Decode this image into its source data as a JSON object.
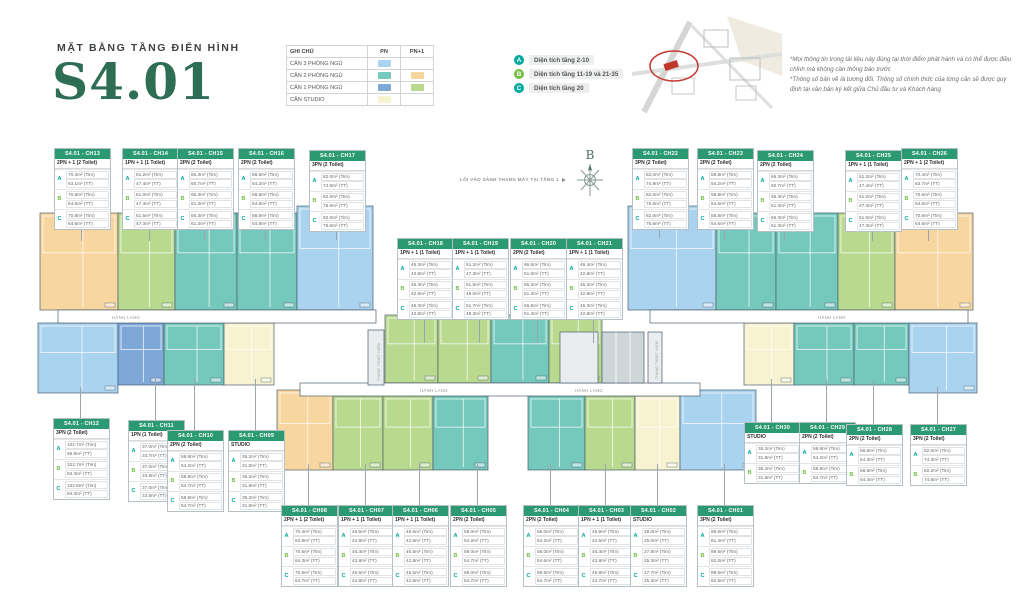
{
  "header": {
    "subtitle": "MẶT BẰNG TẦNG ĐIỂN HÌNH",
    "title": "S4.01"
  },
  "colors": {
    "pn3": "#a9d3ee",
    "pn2": "#74c8bc",
    "pn2p1": "#f8d6a0",
    "pn1": "#7ea8d8",
    "pn1p1": "#b9d98e",
    "studio": "#f7f2d0",
    "accent_teal": "#00a99d",
    "accent_green": "#72bf44",
    "header_green": "#2b9a72",
    "title_green": "#2e6e55"
  },
  "legend": {
    "title": "GHI CHÚ",
    "columns": [
      "PN",
      "PN+1"
    ],
    "rows": [
      {
        "label": "CĂN 3 PHÒNG NGỦ",
        "pn": "pn3",
        "pn1": null
      },
      {
        "label": "CĂN 2 PHÒNG NGỦ",
        "pn": "pn2",
        "pn1": "pn2p1"
      },
      {
        "label": "CĂN 1 PHÒNG NGỦ",
        "pn": "pn1",
        "pn1": "pn1p1"
      },
      {
        "label": "CĂN STUDIO",
        "pn": "studio",
        "pn1": null
      }
    ]
  },
  "floors_legend": [
    {
      "key": "A",
      "color": "teal",
      "label": "Diện tích tầng 2-10"
    },
    {
      "key": "B",
      "color": "green",
      "label": "Diện tích tầng 11-19 và 21-35"
    },
    {
      "key": "C",
      "color": "teal",
      "label": "Diện tích tầng 20"
    }
  ],
  "disclaimer": {
    "lines": [
      "*Mọi thông tin trong tài liệu này đúng tại thời điểm phát hành và có thể được điều chỉnh mà không cần thông báo trước",
      "*Thông số bản vẽ là tương đối. Thông số chính thức của từng căn sẽ được quy định tại văn bản ký kết giữa Chủ đầu tư và Khách hàng"
    ]
  },
  "compass_label": "B",
  "plan": {
    "entry_note": "LỐI VÀO SẢNH THANG MÁY TẠI TẦNG 1",
    "corridor_label": "HÀNH LANG",
    "stair_label": "THANG THOÁT HIỂM",
    "corridors": [
      {
        "x": 58,
        "y": 310,
        "w": 318,
        "h": 13,
        "label_x": [
          112
        ]
      },
      {
        "x": 650,
        "y": 310,
        "w": 318,
        "h": 13,
        "label_x": [
          818
        ]
      },
      {
        "x": 300,
        "y": 383,
        "w": 400,
        "h": 13,
        "label_x": [
          420,
          575
        ]
      }
    ],
    "cores": [
      {
        "x": 368,
        "y": 330,
        "w": 16,
        "h": 55,
        "kind": "stair"
      },
      {
        "x": 560,
        "y": 332,
        "w": 38,
        "h": 51,
        "kind": "lobby"
      },
      {
        "x": 602,
        "y": 332,
        "w": 42,
        "h": 51,
        "kind": "elevator"
      },
      {
        "x": 648,
        "y": 332,
        "w": 14,
        "h": 51,
        "kind": "stair"
      }
    ]
  },
  "units": [
    {
      "id": "S4.01 - CH13",
      "type": "2PN + 1 (2 Toilet)",
      "t": "pn2p1",
      "card": {
        "x": 54,
        "y": 148
      },
      "plan": {
        "x": 40,
        "y": 213,
        "w": 78,
        "h": 97
      },
      "rows": [
        [
          "A",
          "70.4m² (Tim)",
          "63.1m² (TT)"
        ],
        [
          "B",
          "70.8m² (Tim)",
          "64.6m² (TT)"
        ],
        [
          "C",
          "70.8m² (Tim)",
          "64.6m² (TT)"
        ]
      ]
    },
    {
      "id": "S4.01 - CH14",
      "type": "1PN + 1 (1 Toilet)",
      "t": "pn1p1",
      "card": {
        "x": 122,
        "y": 148
      },
      "plan": {
        "x": 118,
        "y": 213,
        "w": 57,
        "h": 97
      },
      "rows": [
        [
          "A",
          "51.2m² (Tim)",
          "47.4m² (TT)"
        ],
        [
          "B",
          "51.0m² (Tim)",
          "47.3m² (TT)"
        ],
        [
          "C",
          "51.5m² (Tim)",
          "47.3m² (TT)"
        ]
      ]
    },
    {
      "id": "S4.01 - CH15",
      "type": "2PN (2 Toilet)",
      "t": "pn2",
      "card": {
        "x": 177,
        "y": 148
      },
      "plan": {
        "x": 175,
        "y": 213,
        "w": 62,
        "h": 97
      },
      "rows": [
        [
          "A",
          "66.3m² (Tim)",
          "60.7m² (TT)"
        ],
        [
          "B",
          "66.3m² (Tim)",
          "61.3m² (TT)"
        ],
        [
          "C",
          "66.3m² (Tim)",
          "61.3m² (TT)"
        ]
      ]
    },
    {
      "id": "S4.01 - CH16",
      "type": "2PN (2 Toilet)",
      "t": "pn2",
      "card": {
        "x": 238,
        "y": 148
      },
      "plan": {
        "x": 237,
        "y": 213,
        "w": 60,
        "h": 97
      },
      "rows": [
        [
          "A",
          "58.8m² (Tim)",
          "54.2m² (TT)"
        ],
        [
          "B",
          "58.8m² (Tim)",
          "54.8m² (TT)"
        ],
        [
          "C",
          "58.8m² (Tim)",
          "54.8m² (TT)"
        ]
      ]
    },
    {
      "id": "S4.01 - CH17",
      "type": "3PN (2 Toilet)",
      "t": "pn3",
      "card": {
        "x": 309,
        "y": 150
      },
      "plan": {
        "x": 297,
        "y": 206,
        "w": 76,
        "h": 104
      },
      "rows": [
        [
          "A",
          "82.0m² (Tim)",
          "74.9m² (TT)"
        ],
        [
          "B",
          "82.0m² (Tim)",
          "75.6m² (TT)"
        ],
        [
          "C",
          "82.0m² (Tim)",
          "75.6m² (TT)"
        ]
      ]
    },
    {
      "id": "S4.01 - CH18",
      "type": "1PN + 1 (1 Toilet)",
      "t": "pn1p1",
      "card": {
        "x": 397,
        "y": 238
      },
      "plan": {
        "x": 385,
        "y": 315,
        "w": 53,
        "h": 68
      },
      "rows": [
        [
          "A",
          "46.3m² (Tim)",
          "42.8m² (TT)"
        ],
        [
          "B",
          "46.3m² (Tim)",
          "42.8m² (TT)"
        ],
        [
          "C",
          "46.3m² (Tim)",
          "42.8m² (TT)"
        ]
      ]
    },
    {
      "id": "S4.01 - CH19",
      "type": "1PN + 1 (1 Toilet)",
      "t": "pn1p1",
      "card": {
        "x": 452,
        "y": 238
      },
      "plan": {
        "x": 438,
        "y": 315,
        "w": 53,
        "h": 68
      },
      "rows": [
        [
          "A",
          "51.2m² (Tim)",
          "47.3m² (TT)"
        ],
        [
          "B",
          "51.5m² (Tim)",
          "48.0m² (TT)"
        ],
        [
          "C",
          "51.7m² (Tim)",
          "48.3m² (TT)"
        ]
      ]
    },
    {
      "id": "S4.01 - CH20",
      "type": "2PN (2 Toilet)",
      "t": "pn2",
      "card": {
        "x": 510,
        "y": 238
      },
      "plan": {
        "x": 491,
        "y": 315,
        "w": 58,
        "h": 68
      },
      "rows": [
        [
          "A",
          "66.6m² (Tim)",
          "61.0m² (TT)"
        ],
        [
          "B",
          "66.3m² (Tim)",
          "61.3m² (TT)"
        ],
        [
          "C",
          "66.6m² (Tim)",
          "61.4m² (TT)"
        ]
      ]
    },
    {
      "id": "S4.01 - CH21",
      "type": "1PN + 1 (1 Toilet)",
      "t": "pn1p1",
      "card": {
        "x": 566,
        "y": 238
      },
      "plan": {
        "x": 549,
        "y": 315,
        "w": 53,
        "h": 68
      },
      "rows": [
        [
          "A",
          "46.4m² (Tim)",
          "42.8m² (TT)"
        ],
        [
          "B",
          "46.3m² (Tim)",
          "42.8m² (TT)"
        ],
        [
          "C",
          "46.3m² (Tim)",
          "42.8m² (TT)"
        ]
      ]
    },
    {
      "id": "S4.01 - CH22",
      "type": "3PN (2 Toilet)",
      "t": "pn3",
      "card": {
        "x": 632,
        "y": 148
      },
      "plan": {
        "x": 628,
        "y": 206,
        "w": 88,
        "h": 104
      },
      "rows": [
        [
          "A",
          "82.0m² (Tim)",
          "74.9m² (TT)"
        ],
        [
          "B",
          "82.0m² (Tim)",
          "75.6m² (TT)"
        ],
        [
          "C",
          "82.0m² (Tim)",
          "75.6m² (TT)"
        ]
      ]
    },
    {
      "id": "S4.01 - CH23",
      "type": "2PN (2 Toilet)",
      "t": "pn2",
      "card": {
        "x": 697,
        "y": 148
      },
      "plan": {
        "x": 716,
        "y": 213,
        "w": 60,
        "h": 97
      },
      "rows": [
        [
          "A",
          "58.8m² (Tim)",
          "54.2m² (TT)"
        ],
        [
          "B",
          "58.8m² (Tim)",
          "54.6m² (TT)"
        ],
        [
          "C",
          "58.8m² (Tim)",
          "54.6m² (TT)"
        ]
      ]
    },
    {
      "id": "S4.01 - CH24",
      "type": "2PN (2 Toilet)",
      "t": "pn2",
      "card": {
        "x": 757,
        "y": 150
      },
      "plan": {
        "x": 776,
        "y": 213,
        "w": 62,
        "h": 97
      },
      "rows": [
        [
          "A",
          "66.3m² (Tim)",
          "60.7m² (TT)"
        ],
        [
          "B",
          "66.3m² (Tim)",
          "61.3m² (TT)"
        ],
        [
          "C",
          "66.3m² (Tim)",
          "61.3m² (TT)"
        ]
      ]
    },
    {
      "id": "S4.01 - CH25",
      "type": "1PN + 1 (1 Toilet)",
      "t": "pn1p1",
      "card": {
        "x": 845,
        "y": 150
      },
      "plan": {
        "x": 838,
        "y": 213,
        "w": 57,
        "h": 97
      },
      "rows": [
        [
          "A",
          "51.2m² (Tim)",
          "47.4m² (TT)"
        ],
        [
          "B",
          "51.2m² (Tim)",
          "47.3m² (TT)"
        ],
        [
          "C",
          "51.5m² (Tim)",
          "47.3m² (TT)"
        ]
      ]
    },
    {
      "id": "S4.01 - CH26",
      "type": "2PN + 1 (2 Toilet)",
      "t": "pn2p1",
      "card": {
        "x": 901,
        "y": 148
      },
      "plan": {
        "x": 895,
        "y": 213,
        "w": 78,
        "h": 97
      },
      "rows": [
        [
          "A",
          "70.4m² (Tim)",
          "63.7m² (TT)"
        ],
        [
          "B",
          "70.6m² (Tim)",
          "64.6m² (TT)"
        ],
        [
          "C",
          "70.6m² (Tim)",
          "64.6m² (TT)"
        ]
      ]
    },
    {
      "id": "S4.01 - CH12",
      "type": "3PN (2 Toilet)",
      "t": "pn3",
      "card": {
        "x": 53,
        "y": 418
      },
      "plan": {
        "x": 38,
        "y": 323,
        "w": 80,
        "h": 70
      },
      "rows": [
        [
          "A",
          "102.7m² (Tim)",
          "95.8m² (TT)"
        ],
        [
          "B",
          "102.7m² (Tim)",
          "94.3m² (TT)"
        ],
        [
          "C",
          "102.8m² (Tim)",
          "94.3m² (TT)"
        ]
      ]
    },
    {
      "id": "S4.01 - CH11",
      "type": "1PN (1 Toilet)",
      "t": "pn1",
      "card": {
        "x": 128,
        "y": 420
      },
      "plan": {
        "x": 118,
        "y": 323,
        "w": 46,
        "h": 62
      },
      "rows": [
        [
          "A",
          "37.0m² (Tim)",
          "33.7m² (TT)"
        ],
        [
          "B",
          "37.0m² (Tim)",
          "33.8m² (TT)"
        ],
        [
          "C",
          "37.0m² (Tim)",
          "33.8m² (TT)"
        ]
      ]
    },
    {
      "id": "S4.01 - CH10",
      "type": "2PN (2 Toilet)",
      "t": "pn2",
      "card": {
        "x": 167,
        "y": 430
      },
      "plan": {
        "x": 164,
        "y": 323,
        "w": 60,
        "h": 62
      },
      "rows": [
        [
          "A",
          "58.8m² (Tim)",
          "54.2m² (TT)"
        ],
        [
          "B",
          "58.8m² (Tim)",
          "54.7m² (TT)"
        ],
        [
          "C",
          "58.8m² (Tim)",
          "54.7m² (TT)"
        ]
      ]
    },
    {
      "id": "S4.01 - CH09",
      "type": "STUDIO",
      "t": "studio",
      "card": {
        "x": 228,
        "y": 430
      },
      "plan": {
        "x": 224,
        "y": 323,
        "w": 50,
        "h": 62
      },
      "rows": [
        [
          "A",
          "35.2m² (Tim)",
          "31.8m² (TT)"
        ],
        [
          "B",
          "35.2m² (Tim)",
          "31.8m² (TT)"
        ],
        [
          "C",
          "35.2m² (Tim)",
          "31.8m² (TT)"
        ]
      ]
    },
    {
      "id": "S4.01 - CH30",
      "type": "STUDIO",
      "t": "studio",
      "card": {
        "x": 744,
        "y": 422
      },
      "plan": {
        "x": 744,
        "y": 323,
        "w": 50,
        "h": 62
      },
      "rows": [
        [
          "A",
          "35.2m² (Tim)",
          "31.8m² (TT)"
        ],
        [
          "B",
          "35.2m² (Tim)",
          "31.8m² (TT)"
        ]
      ]
    },
    {
      "id": "S4.01 - CH29",
      "type": "2PN (2 Toilet)",
      "t": "pn2",
      "card": {
        "x": 799,
        "y": 422
      },
      "plan": {
        "x": 794,
        "y": 323,
        "w": 60,
        "h": 62
      },
      "rows": [
        [
          "A",
          "58.8m² (Tim)",
          "54.2m² (TT)"
        ],
        [
          "B",
          "58.8m² (Tim)",
          "54.7m² (TT)"
        ]
      ]
    },
    {
      "id": "S4.01 - CH28",
      "type": "2PN (2 Toilet)",
      "t": "pn2",
      "card": {
        "x": 846,
        "y": 424
      },
      "plan": {
        "x": 854,
        "y": 323,
        "w": 55,
        "h": 62
      },
      "rows": [
        [
          "A",
          "58.8m² (Tim)",
          "54.3m² (TT)"
        ],
        [
          "B",
          "58.8m² (Tim)",
          "54.4m² (TT)"
        ]
      ]
    },
    {
      "id": "S4.01 - CH27",
      "type": "3PN (2 Toilet)",
      "t": "pn3",
      "card": {
        "x": 910,
        "y": 424
      },
      "plan": {
        "x": 909,
        "y": 323,
        "w": 68,
        "h": 70
      },
      "rows": [
        [
          "A",
          "82.0m² (Tim)",
          "74.3m² (TT)"
        ],
        [
          "B",
          "82.2m² (Tim)",
          "74.8m² (TT)"
        ]
      ]
    },
    {
      "id": "S4.01 - CH08",
      "type": "2PN + 1 (2 Toilet)",
      "t": "pn2p1",
      "card": {
        "x": 281,
        "y": 505
      },
      "plan": {
        "x": 277,
        "y": 390,
        "w": 56,
        "h": 80
      },
      "rows": [
        [
          "A",
          "70.4m² (Tim)",
          "63.8m² (TT)"
        ],
        [
          "B",
          "70.6m² (Tim)",
          "64.3m² (TT)"
        ],
        [
          "C",
          "70.6m² (Tim)",
          "64.7m² (TT)"
        ]
      ]
    },
    {
      "id": "S4.01 - CH07",
      "type": "1PN + 1 (1 Toilet)",
      "t": "pn1p1",
      "card": {
        "x": 338,
        "y": 505
      },
      "plan": {
        "x": 333,
        "y": 396,
        "w": 50,
        "h": 74
      },
      "rows": [
        [
          "A",
          "46.5m² (Tim)",
          "42.8m² (TT)"
        ],
        [
          "B",
          "46.3m² (Tim)",
          "42.8m² (TT)"
        ],
        [
          "C",
          "46.5m² (Tim)",
          "42.8m² (TT)"
        ]
      ]
    },
    {
      "id": "S4.01 - CH06",
      "type": "1PN + 1 (1 Toilet)",
      "t": "pn1p1",
      "card": {
        "x": 392,
        "y": 505
      },
      "plan": {
        "x": 383,
        "y": 396,
        "w": 50,
        "h": 74
      },
      "rows": [
        [
          "A",
          "46.5m² (Tim)",
          "42.8m² (TT)"
        ],
        [
          "B",
          "46.5m² (Tim)",
          "42.8m² (TT)"
        ],
        [
          "C",
          "46.5m² (Tim)",
          "42.8m² (TT)"
        ]
      ]
    },
    {
      "id": "S4.01 - CH05",
      "type": "2PN (2 Toilet)",
      "t": "pn2",
      "card": {
        "x": 450,
        "y": 505
      },
      "plan": {
        "x": 433,
        "y": 396,
        "w": 55,
        "h": 74
      },
      "rows": [
        [
          "A",
          "59.0m² (Tim)",
          "54.2m² (TT)"
        ],
        [
          "B",
          "59.0m² (Tim)",
          "54.7m² (TT)"
        ],
        [
          "C",
          "59.0m² (Tim)",
          "54.7m² (TT)"
        ]
      ]
    },
    {
      "id": "S4.01 - CH04",
      "type": "2PN (2 Toilet)",
      "t": "pn2",
      "card": {
        "x": 523,
        "y": 505
      },
      "plan": {
        "x": 528,
        "y": 396,
        "w": 57,
        "h": 74
      },
      "rows": [
        [
          "A",
          "58.0m² (Tim)",
          "54.2m² (TT)"
        ],
        [
          "B",
          "58.0m² (Tim)",
          "54.6m² (TT)"
        ],
        [
          "C",
          "58.5m² (Tim)",
          "54.7m² (TT)"
        ]
      ]
    },
    {
      "id": "S4.01 - CH03",
      "type": "1PN + 1 (1 Toilet)",
      "t": "pn1p1",
      "card": {
        "x": 578,
        "y": 505
      },
      "plan": {
        "x": 585,
        "y": 396,
        "w": 50,
        "h": 74
      },
      "rows": [
        [
          "A",
          "45.9m² (Tim)",
          "42.6m² (TT)"
        ],
        [
          "B",
          "46.3m² (Tim)",
          "42.8m² (TT)"
        ],
        [
          "C",
          "45.8m² (Tim)",
          "42.7m² (TT)"
        ]
      ]
    },
    {
      "id": "S4.01 - CH02",
      "type": "STUDIO",
      "t": "studio",
      "card": {
        "x": 630,
        "y": 505
      },
      "plan": {
        "x": 635,
        "y": 396,
        "w": 45,
        "h": 74
      },
      "rows": [
        [
          "A",
          "28.0m² (Tim)",
          "25.0m² (TT)"
        ],
        [
          "B",
          "27.8m² (Tim)",
          "25.3m² (TT)"
        ],
        [
          "C",
          "27.7m² (Tim)",
          "25.3m² (TT)"
        ]
      ]
    },
    {
      "id": "S4.01 - CH01",
      "type": "3PN (2 Toilet)",
      "t": "pn3",
      "card": {
        "x": 697,
        "y": 505
      },
      "plan": {
        "x": 680,
        "y": 390,
        "w": 76,
        "h": 80
      },
      "rows": [
        [
          "A",
          "89.6m² (Tim)",
          "81.4m² (TT)"
        ],
        [
          "B",
          "89.6m² (Tim)",
          "82.0m² (TT)"
        ],
        [
          "C",
          "89.6m² (Tim)",
          "82.5m² (TT)"
        ]
      ]
    }
  ]
}
